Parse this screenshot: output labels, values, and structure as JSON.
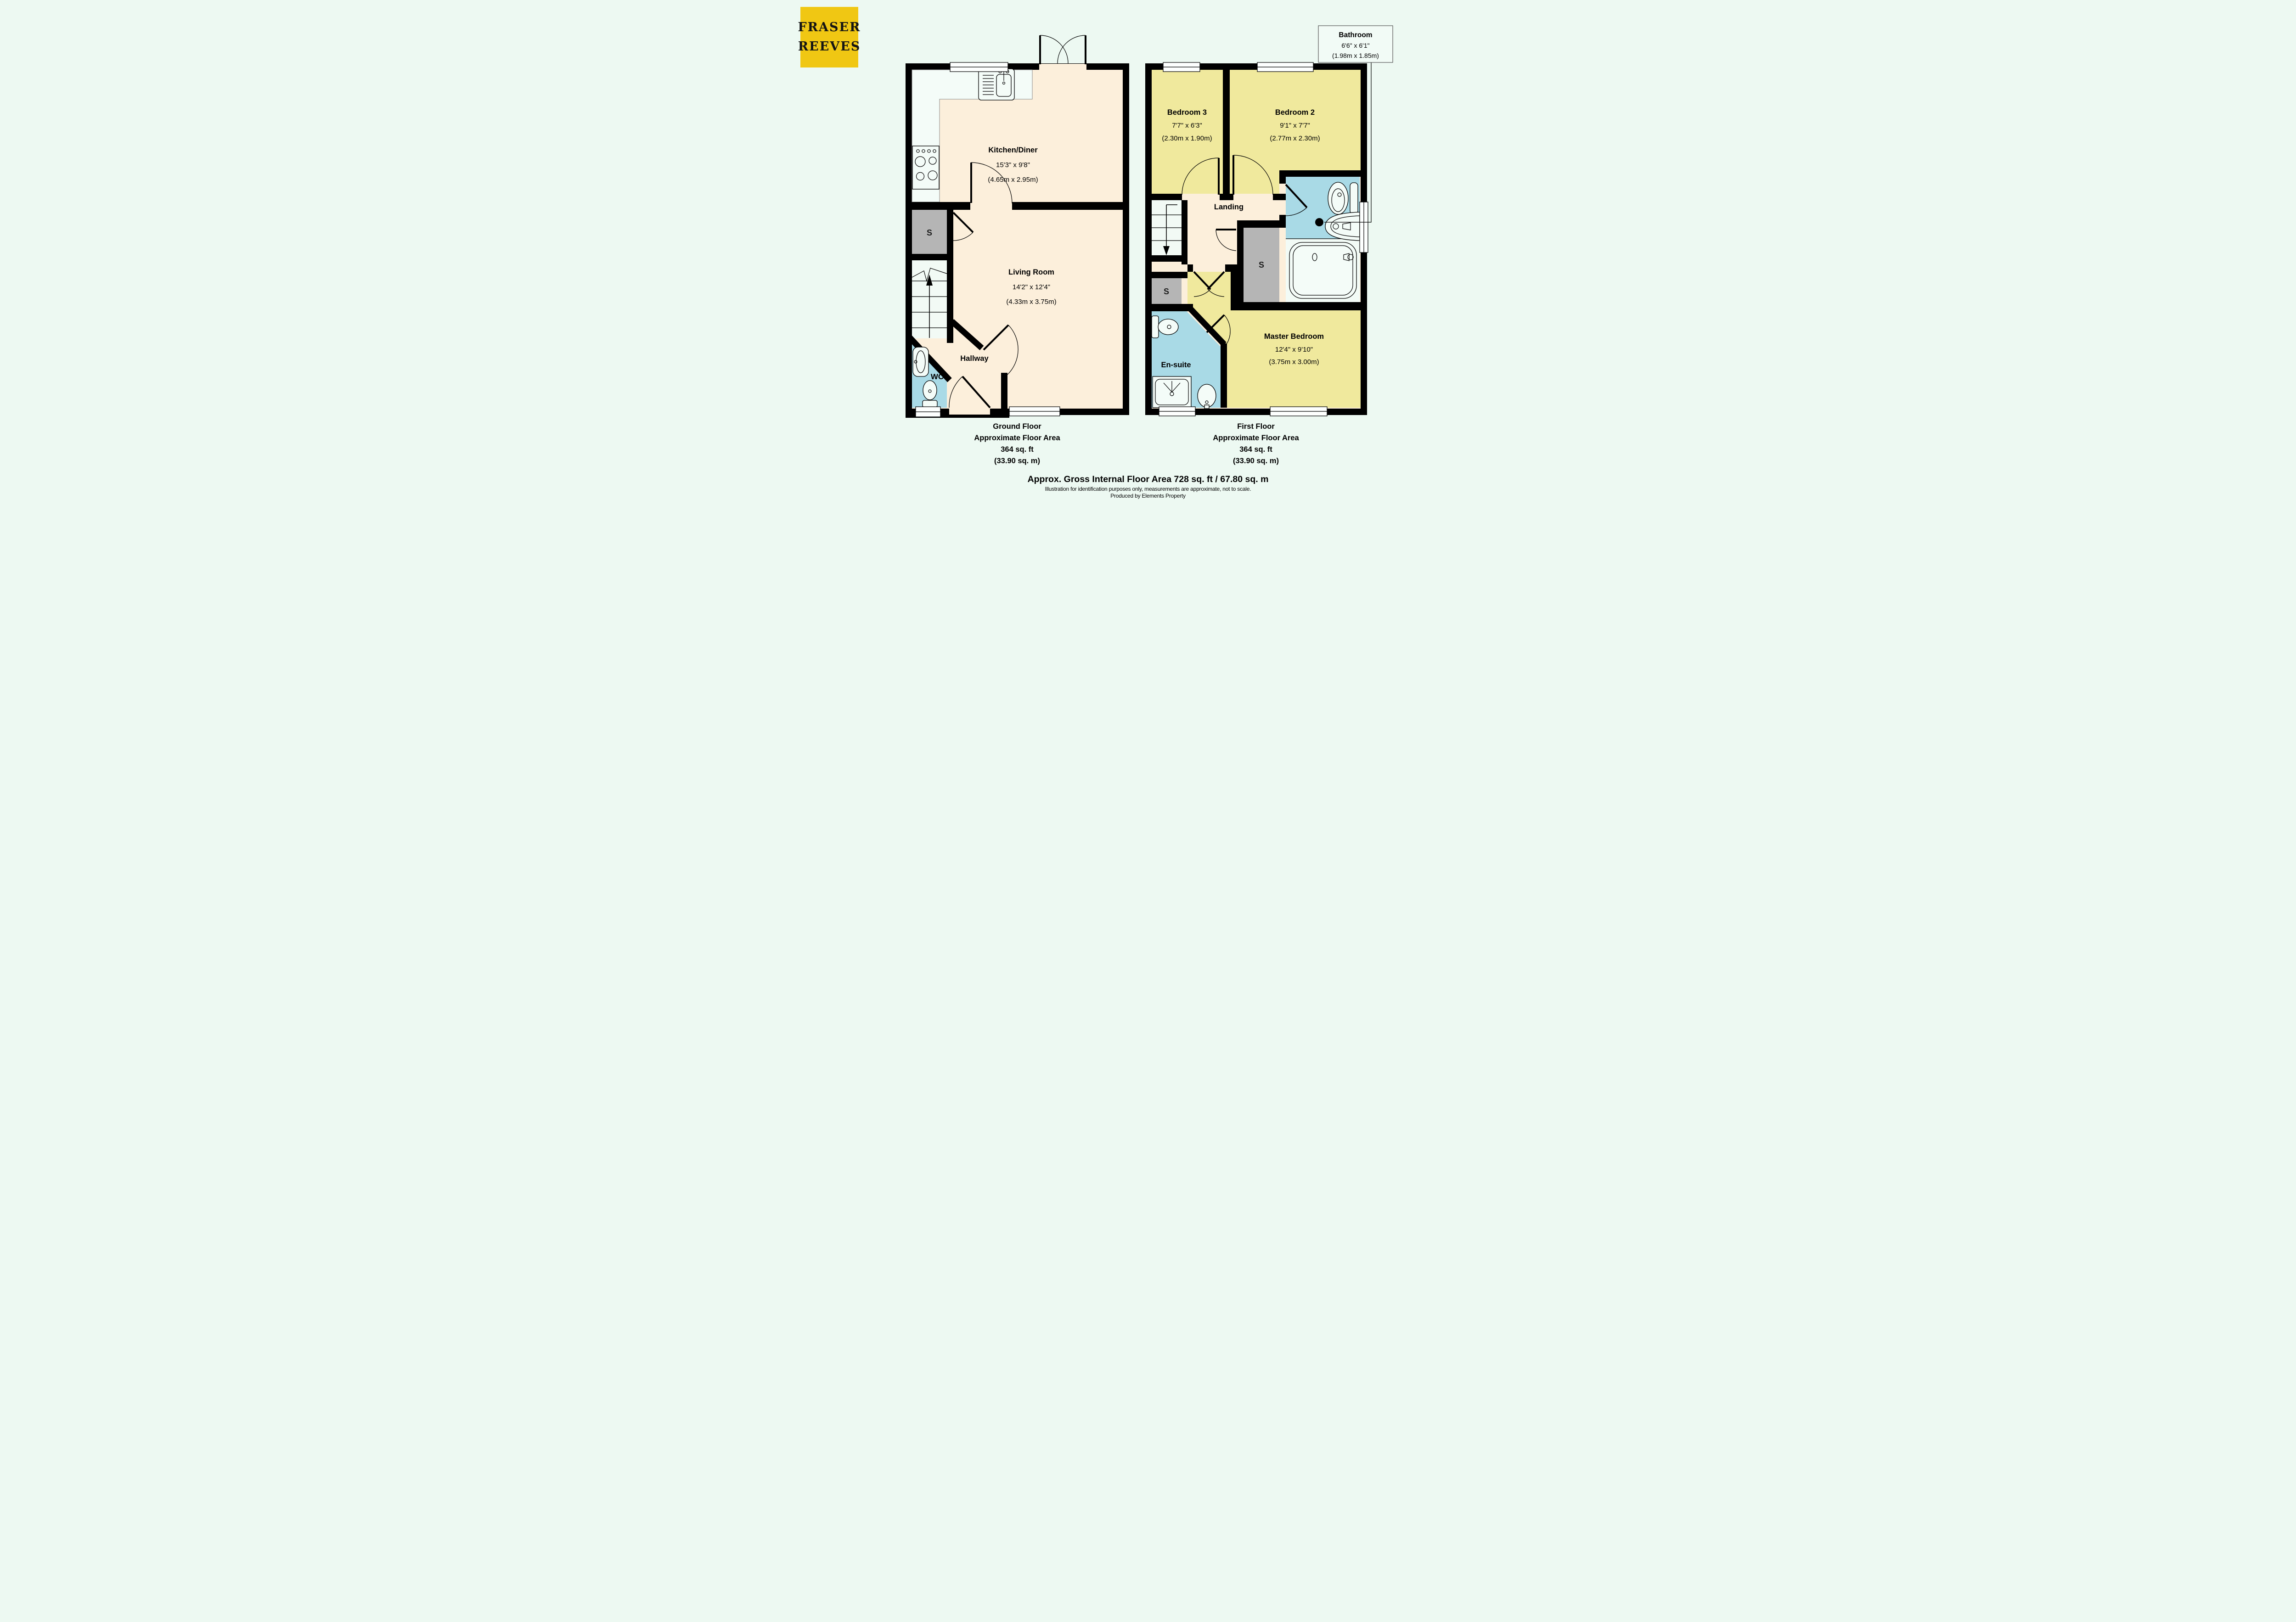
{
  "page": {
    "background": "#edf9f2"
  },
  "branding": {
    "line1": "FRASER",
    "line2": "REEVES",
    "bg_color": "#f0c713",
    "text_color": "#141414"
  },
  "colors": {
    "wall": "#000000",
    "floor_cream": "#fcefdb",
    "floor_yellow": "#f0e99d",
    "wet_room_blue": "#a9dae6",
    "storage_gray": "#b5b5b5",
    "fixture_white": "#f4fcf8"
  },
  "ground_floor": {
    "kitchen": {
      "name": "Kitchen/Diner",
      "imperial": "15'3\" x 9'8\"",
      "metric": "(4.65m x 2.95m)"
    },
    "living": {
      "name": "Living Room",
      "imperial": "14'2\" x 12'4\"",
      "metric": "(4.33m x 3.75m)"
    },
    "hallway": {
      "name": "Hallway"
    },
    "wc": {
      "name": "WC"
    },
    "storage": {
      "label": "S"
    },
    "caption": {
      "line1": "Ground Floor",
      "line2": "Approximate Floor Area",
      "line3": "364 sq. ft",
      "line4": "(33.90 sq. m)"
    }
  },
  "first_floor": {
    "bedroom3": {
      "name": "Bedroom 3",
      "imperial": "7'7\" x 6'3\"",
      "metric": "(2.30m x 1.90m)"
    },
    "bedroom2": {
      "name": "Bedroom 2",
      "imperial": "9'1\" x 7'7\"",
      "metric": "(2.77m x 2.30m)"
    },
    "master": {
      "name": "Master Bedroom",
      "imperial": "12'4\" x 9'10\"",
      "metric": "(3.75m x 3.00m)"
    },
    "landing": {
      "name": "Landing"
    },
    "ensuite": {
      "name": "En-suite"
    },
    "storage_mid": {
      "label": "S"
    },
    "storage_left": {
      "label": "S"
    },
    "bathroom_callout": {
      "name": "Bathroom",
      "imperial": "6'6\" x 6'1\"",
      "metric": "(1.98m x 1.85m)"
    },
    "caption": {
      "line1": "First Floor",
      "line2": "Approximate Floor Area",
      "line3": "364 sq. ft",
      "line4": "(33.90 sq. m)"
    }
  },
  "footer": {
    "gross_area": "Approx. Gross Internal Floor Area 728 sq. ft / 67.80 sq. m",
    "disclaimer": "Illustration for identification purposes only, measurements are approximate, not to scale.",
    "produced_by": "Produced by Elements Property"
  }
}
